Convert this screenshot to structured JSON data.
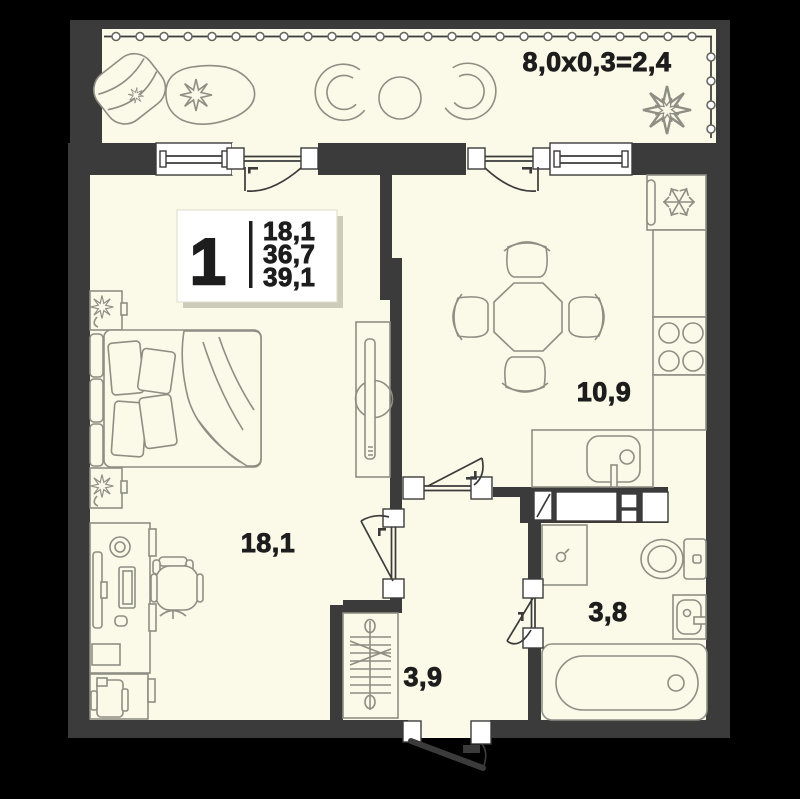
{
  "plan_card": {
    "rooms_count": "1",
    "living_area": "18,1",
    "apartment_area": "36,7",
    "total_area": "39,1"
  },
  "room_labels": {
    "balcony_formula": "8,0x0,3=2,4",
    "living_room": "18,1",
    "kitchen": "10,9",
    "bathroom": "3,8",
    "hallway": "3,9"
  },
  "icons": {
    "fridge_badge": "snowflake"
  },
  "colors": {
    "background": "#000000",
    "walls": "#3b3b3b",
    "floor": "#fbf9e7",
    "furniture_outline": "#8f8e84",
    "window_fill": "#ffffff",
    "text": "#1d1d1d"
  }
}
